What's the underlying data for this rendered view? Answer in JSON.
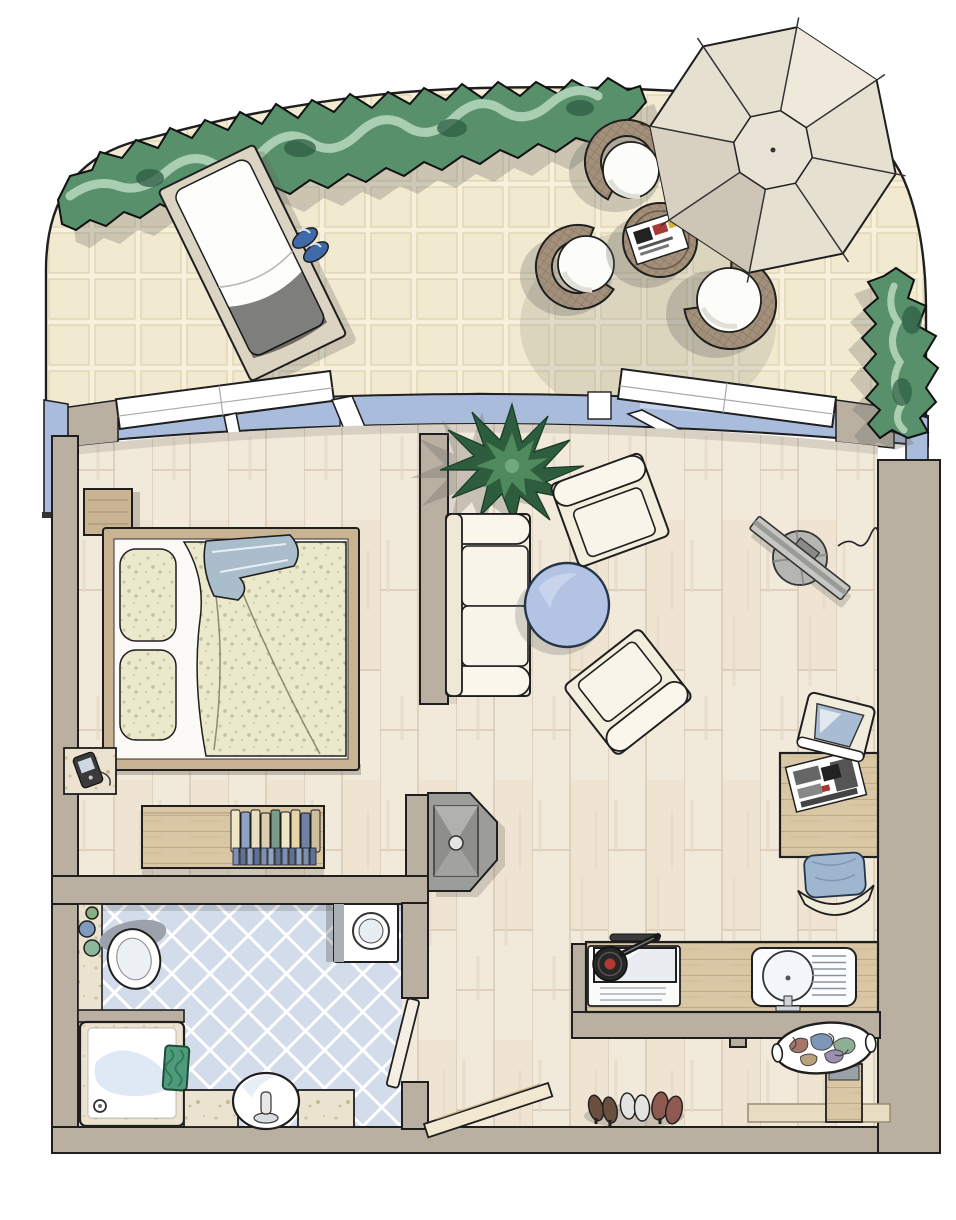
{
  "document": {
    "kind": "apartment-floor-plan-illustration",
    "visible_text": ""
  },
  "palette": {
    "outline": "#1f1f1f",
    "wall": "#b9b0a2",
    "terrace_tile": "#f1e9d0",
    "terrace_grout": "#f6f0dc",
    "tile_edge": "#d9cda6",
    "hedge_dark": "#2c5c41",
    "hedge_mid": "#58906b",
    "hedge_light": "#a9ceb1",
    "umbrella": "#e6e0d1",
    "umbrella_shade": "#cdc6b6",
    "umbrella_cap": "#e9e3d5",
    "wicker": "#a3907a",
    "wicker_line": "#83725c",
    "glass": "#a9bcdc",
    "glass_light": "#c9d6ec",
    "wood_floor": "#f1e9da",
    "wood_line": "#d7c7b2",
    "bath_tile": "#d3dcea",
    "marble": "#ebe3cf",
    "kitchen_wood": "#d9c6a4",
    "bed_wood": "#c8b492",
    "cream": "#f3eddc",
    "cushion": "#f8f4e9",
    "table_blue": "#b3c3e3",
    "blanket_blue": "#a9bdcb",
    "chair_blue": "#9fb6cf",
    "plant": "#2e5d3d",
    "plant_light": "#4f8a5e",
    "tv_gray": "#c6c6c3",
    "metal_gray": "#9c9c98",
    "towel": "#4e9a7a",
    "slipper_blue": "#3f69a8",
    "speckle_base": "#ebe9cb",
    "shadow": "rgba(100,100,95,0.28)"
  },
  "rooms": {
    "terrace": {
      "name": "terrace",
      "items": [
        "hedge",
        "shrub",
        "sun-lounger",
        "slippers",
        "parasol",
        "wicker-chair",
        "wicker-chair",
        "wicker-chair",
        "wicker-side-table",
        "magazine"
      ]
    },
    "bedroom": {
      "name": "bedroom",
      "items": [
        "wardrobe",
        "double-bed",
        "pillows",
        "duvet",
        "blanket",
        "nightstand",
        "phone",
        "sideboard",
        "books"
      ]
    },
    "living": {
      "name": "living-room",
      "items": [
        "potted-plant",
        "sofa",
        "round-table",
        "armchair",
        "armchair",
        "tv",
        "stove-cabinet",
        "desk",
        "crt-monitor",
        "newspaper",
        "desk-chair"
      ]
    },
    "kitchen": {
      "name": "kitchenette",
      "items": [
        "counter",
        "cooktop",
        "frying-pan",
        "sink",
        "drainboard"
      ]
    },
    "bathroom": {
      "name": "bathroom",
      "items": [
        "counter",
        "jars",
        "toilet",
        "washing-machine",
        "shower",
        "towel",
        "washbasin",
        "faucet",
        "door"
      ]
    },
    "hallway": {
      "name": "entrance-hall",
      "items": [
        "entrance-door",
        "shoes",
        "laundry-basket",
        "cabinet",
        "doormat"
      ]
    }
  }
}
